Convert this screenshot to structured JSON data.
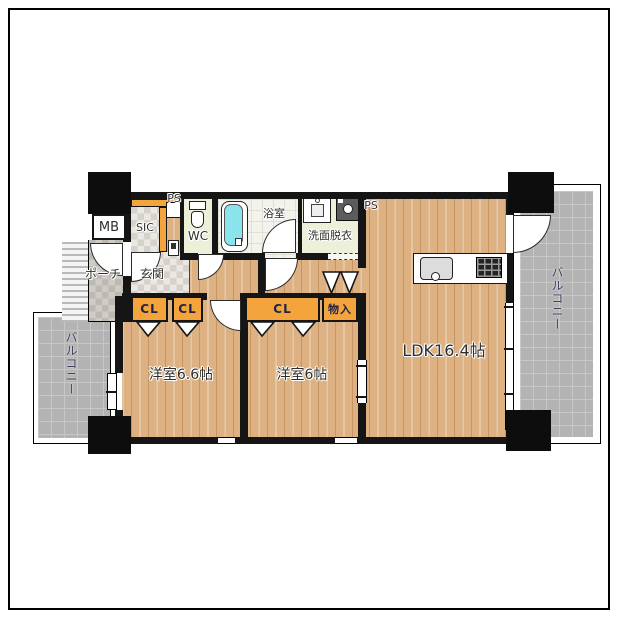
{
  "plan_type": "apartment-floorplan-2LDK",
  "rooms": {
    "ldk": {
      "label": "LDK16.4帖"
    },
    "bedroom1": {
      "label": "洋室6.6帖"
    },
    "bedroom2": {
      "label": "洋室6帖"
    },
    "bath": {
      "label": "浴室"
    },
    "washroom": {
      "label": "洗面脱衣"
    },
    "wc": {
      "label": "WC"
    },
    "sic": {
      "label": "SIC"
    },
    "entrance": {
      "label": "玄関"
    },
    "porch": {
      "label": "ポーチ"
    },
    "meter_box": {
      "label": "MB"
    },
    "pipe_space_top": {
      "label": "PS"
    },
    "pipe_space_right": {
      "label": "PS"
    },
    "balcony_left": {
      "label": "バルコニー"
    },
    "balcony_right": {
      "label": "バルコニー"
    },
    "closet1": {
      "label": "CL"
    },
    "closet2": {
      "label": "CL"
    },
    "closet3": {
      "label": "CL"
    },
    "storage": {
      "label": "物入"
    }
  },
  "colors": {
    "wall": "#151515",
    "wood_floor": "#ddb182",
    "balcony_tile": "#b3b3b3",
    "closet_orange": "#f4a43c",
    "bathtub_cyan": "#8ae4ec",
    "wet_room_green": "#edf0d9",
    "balcony_text": "#3f3f63"
  }
}
